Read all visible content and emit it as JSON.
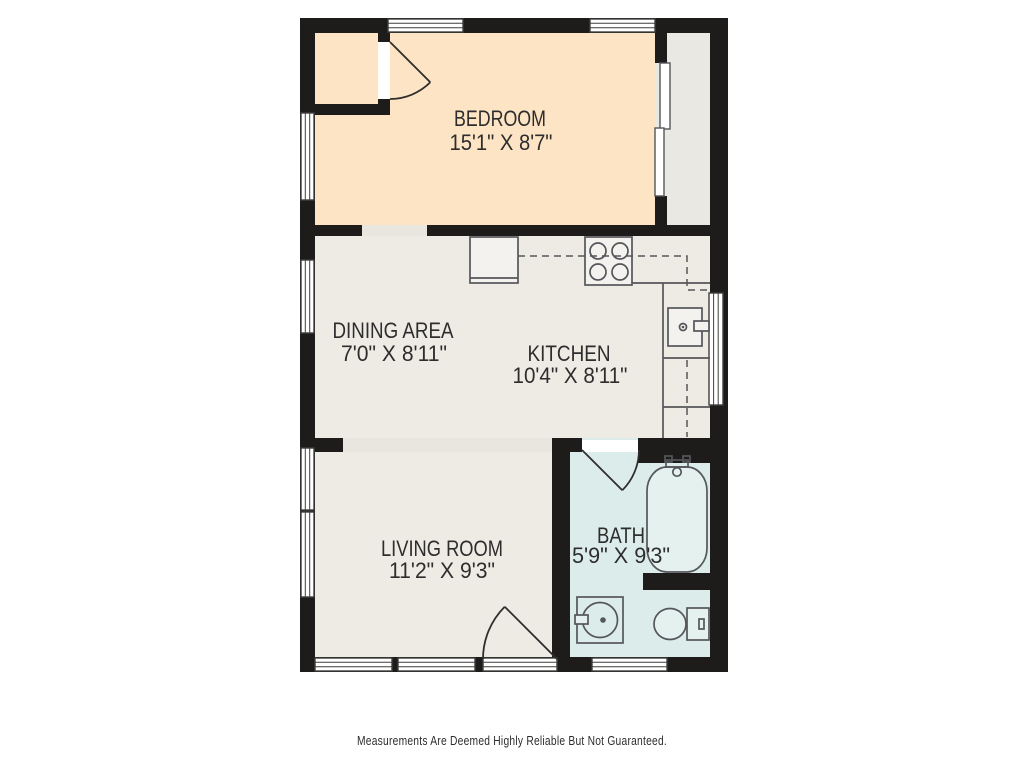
{
  "disclaimer": "Measurements Are Deemed Highly Reliable But Not Guaranteed.",
  "rooms": {
    "bedroom": {
      "name": "BEDROOM",
      "dims": "15'1\" X 8'7\""
    },
    "dining": {
      "name": "DINING AREA",
      "dims": "7'0\" X 8'11\""
    },
    "kitchen": {
      "name": "KITCHEN",
      "dims": "10'4\" X 8'11\""
    },
    "living": {
      "name": "LIVING ROOM",
      "dims": "11'2\" X 9'3\""
    },
    "bath": {
      "name": "BATH",
      "dims": "5'9\" X 9'3\""
    }
  },
  "fixtures": {
    "stove": "stove-4-burner",
    "kitchen_sink": "kitchen-sink",
    "bathtub": "bathtub",
    "vanity": "vanity-sink",
    "toilet": "toilet",
    "closet_doors": "sliding-bypass-doors"
  },
  "palette": {
    "wall": "#1d1c1a",
    "floor-bedroom": "#fce4c4",
    "floor-main": "#eeebe5",
    "floor-closet": "#eae8e3",
    "floor-bath": "#dcecea",
    "opening": "#e9e6e0",
    "line": "#55565a",
    "door": "#2f2e2c",
    "window-stroke": "#3f3f3d",
    "text": "#2d2d2d",
    "fixture-fill": "#f4f2ee",
    "bath-fixture-fill": "#e4f1ef"
  }
}
